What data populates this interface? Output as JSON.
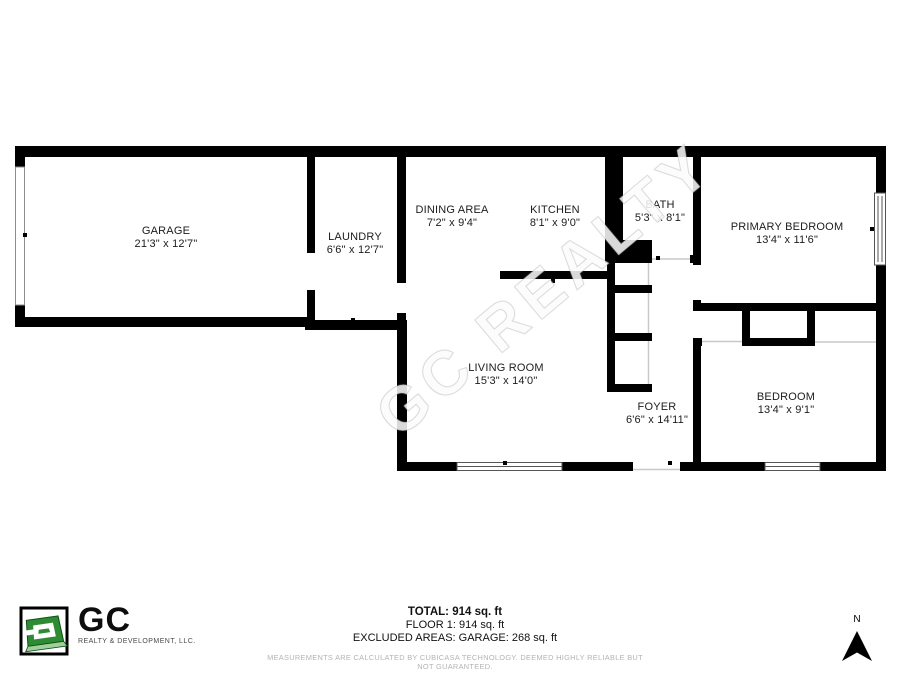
{
  "watermark": {
    "text": "GC REALTY"
  },
  "floorplan": {
    "rooms": [
      {
        "name": "GARAGE",
        "dims": "21'3\" x 12'7\""
      },
      {
        "name": "LAUNDRY",
        "dims": "6'6\" x 12'7\""
      },
      {
        "name": "DINING AREA",
        "dims": "7'2\" x 9'4\""
      },
      {
        "name": "KITCHEN",
        "dims": "8'1\" x 9'0\""
      },
      {
        "name": "BATH",
        "dims": "5'3\" x 8'1\""
      },
      {
        "name": "PRIMARY BEDROOM",
        "dims": "13'4\" x 11'6\""
      },
      {
        "name": "LIVING ROOM",
        "dims": "15'3\" x 14'0\""
      },
      {
        "name": "FOYER",
        "dims": "6'6\" x 14'11\""
      },
      {
        "name": "BEDROOM",
        "dims": "13'4\" x 9'1\""
      }
    ]
  },
  "summary": {
    "total": "TOTAL: 914 sq. ft",
    "floor": "FLOOR 1: 914 sq. ft",
    "excluded": "EXCLUDED AREAS: GARAGE: 268 sq. ft",
    "disclaimer": "MEASUREMENTS ARE CALCULATED BY CUBICASA TECHNOLOGY. DEEMED HIGHLY RELIABLE BUT NOT GUARANTEED."
  },
  "logo": {
    "brand": "GC",
    "tagline": "REALTY & DEVELOPMENT, LLC."
  },
  "compass": {
    "north_label": "N"
  },
  "colors": {
    "wall": "#000000",
    "logo_green": "#2e8b33",
    "logo_green_light": "#9fcf9b",
    "label_text": "#1c1c1c",
    "muted_text": "#b3b3b3"
  }
}
